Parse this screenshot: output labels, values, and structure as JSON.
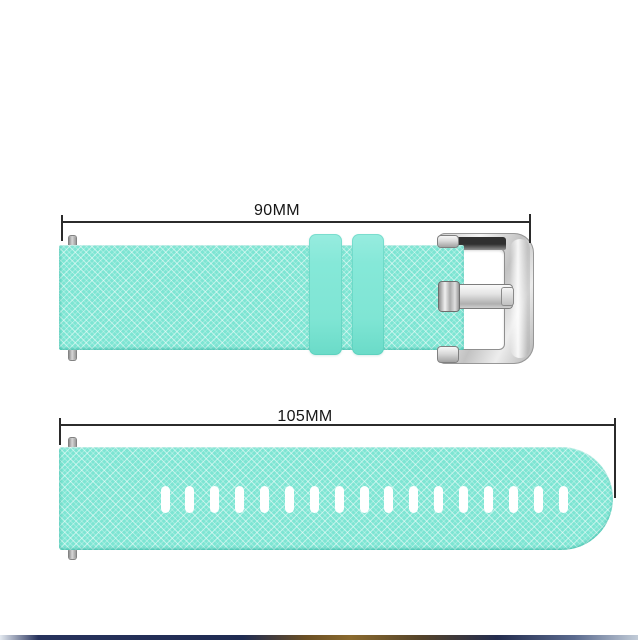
{
  "diagram": {
    "top_piece": {
      "name": "buckle strap piece",
      "measurement_label": "90MM",
      "has_buckle": true,
      "keeper_loop_count": 2,
      "spring_bar_pin_count": 2
    },
    "bottom_piece": {
      "name": "hole strap piece",
      "measurement_label": "105MM",
      "hole_count": 17,
      "spring_bar_pin_count": 2
    }
  },
  "colors": {
    "background": "#FFFFFF",
    "band_base": "#7DE5D3",
    "band_texture_light": "#C3F4EB",
    "keeper": "#85E8D8",
    "annotation": "#2B2B2B",
    "buckle_silver_light": "#F5F5F5",
    "buckle_silver_dark": "#8E8E8E",
    "hole": "#FFFFFF"
  },
  "footer_strip": {
    "colors": [
      "#E3E9F0",
      "#27325C",
      "#1F2B52",
      "#6B4F24",
      "#8A6A2E",
      "#54432A",
      "#232C4E",
      "#5A6A8E",
      "#C2CCD8"
    ],
    "stops": [
      "0%",
      "6%",
      "38%",
      "48%",
      "55%",
      "66%",
      "78%",
      "90%",
      "100%"
    ]
  }
}
